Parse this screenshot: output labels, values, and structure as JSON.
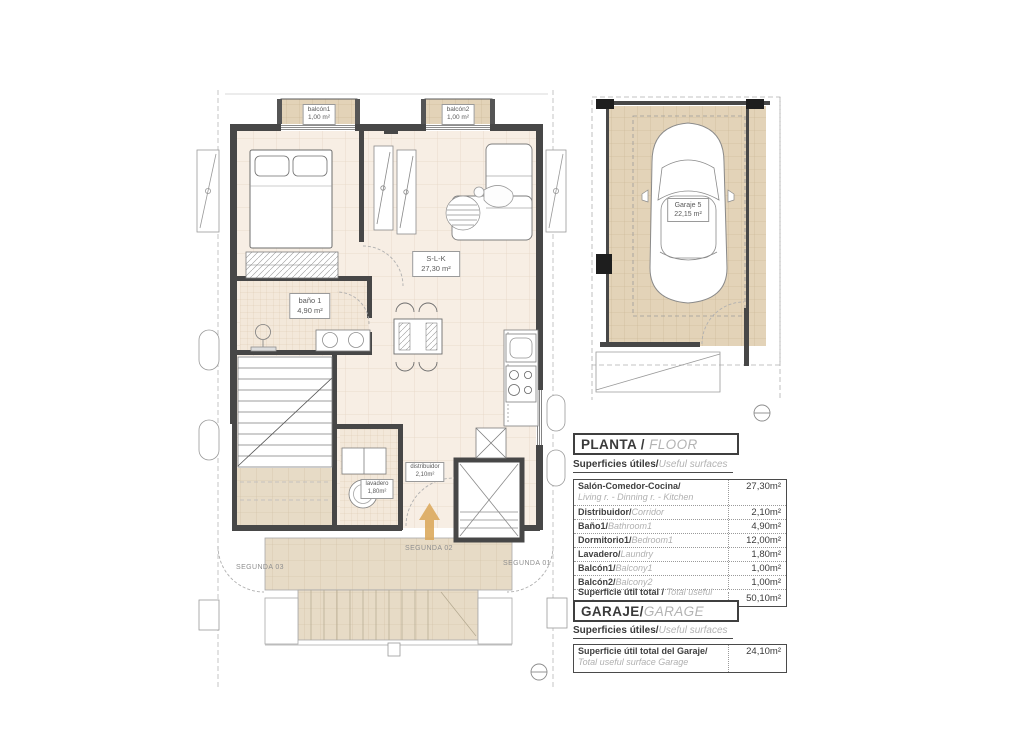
{
  "plan": {
    "rooms": {
      "balcony1": {
        "name": "balcón1",
        "area": "1,00 m²"
      },
      "balcony2": {
        "name": "balcón2",
        "area": "1,00 m²"
      },
      "living": {
        "name": "S-L-K",
        "area": "27,30 m²"
      },
      "bath": {
        "name": "baño 1",
        "area": "4,90 m²"
      },
      "laundry": {
        "name": "lavadero",
        "area": "1,80m²"
      },
      "hall": {
        "name": "distribuidor",
        "area": "2,10m²"
      }
    },
    "annotations": {
      "segunda01": "SEGUNDA 01",
      "segunda02": "SEGUNDA 02",
      "segunda03": "SEGUNDA 03"
    }
  },
  "garage_plan": {
    "label": {
      "name": "Garaje 5",
      "area": "22,15 m²"
    }
  },
  "floor_section": {
    "title": "PLANTA / ",
    "title_en": "FLOOR",
    "subtitle": "Superficies útiles/",
    "subtitle_en": "Useful surfaces",
    "rows": [
      {
        "es": "Salón-Comedor-Cocina/",
        "en": "Living r. - Dinning r. - Kitchen",
        "value": "27,30m²"
      },
      {
        "es": "Distribuidor/",
        "en": "Corridor",
        "value": "2,10m²"
      },
      {
        "es": "Baño1/",
        "en": "Bathroom1",
        "value": "4,90m²"
      },
      {
        "es": "Dormitorio1/",
        "en": "Bedroom1",
        "value": "12,00m²"
      },
      {
        "es": "Lavadero/",
        "en": "Laundry",
        "value": "1,80m²"
      },
      {
        "es": "Balcón1/",
        "en": "Balcony1",
        "value": "1,00m²"
      },
      {
        "es": "Balcón2/",
        "en": "Balcony2",
        "value": "1,00m²"
      }
    ],
    "total": {
      "es": "Superficie útil total / ",
      "en": "Total useful surface",
      "value": "50,10m²"
    }
  },
  "garage_section": {
    "title": "GARAJE/",
    "title_en": "GARAGE",
    "subtitle": "Superficies útiles/",
    "subtitle_en": "Useful surfaces",
    "total": {
      "es": "Superficie útil total del Garaje/",
      "en": "Total useful surface Garage",
      "value": "24,10m²"
    }
  },
  "colors": {
    "floor": "#f7eee4",
    "tile_tan": "#e3d3b8",
    "tile_terrace": "#e7dbc6",
    "wall": "#474747",
    "arrow": "#dcaa5e"
  }
}
